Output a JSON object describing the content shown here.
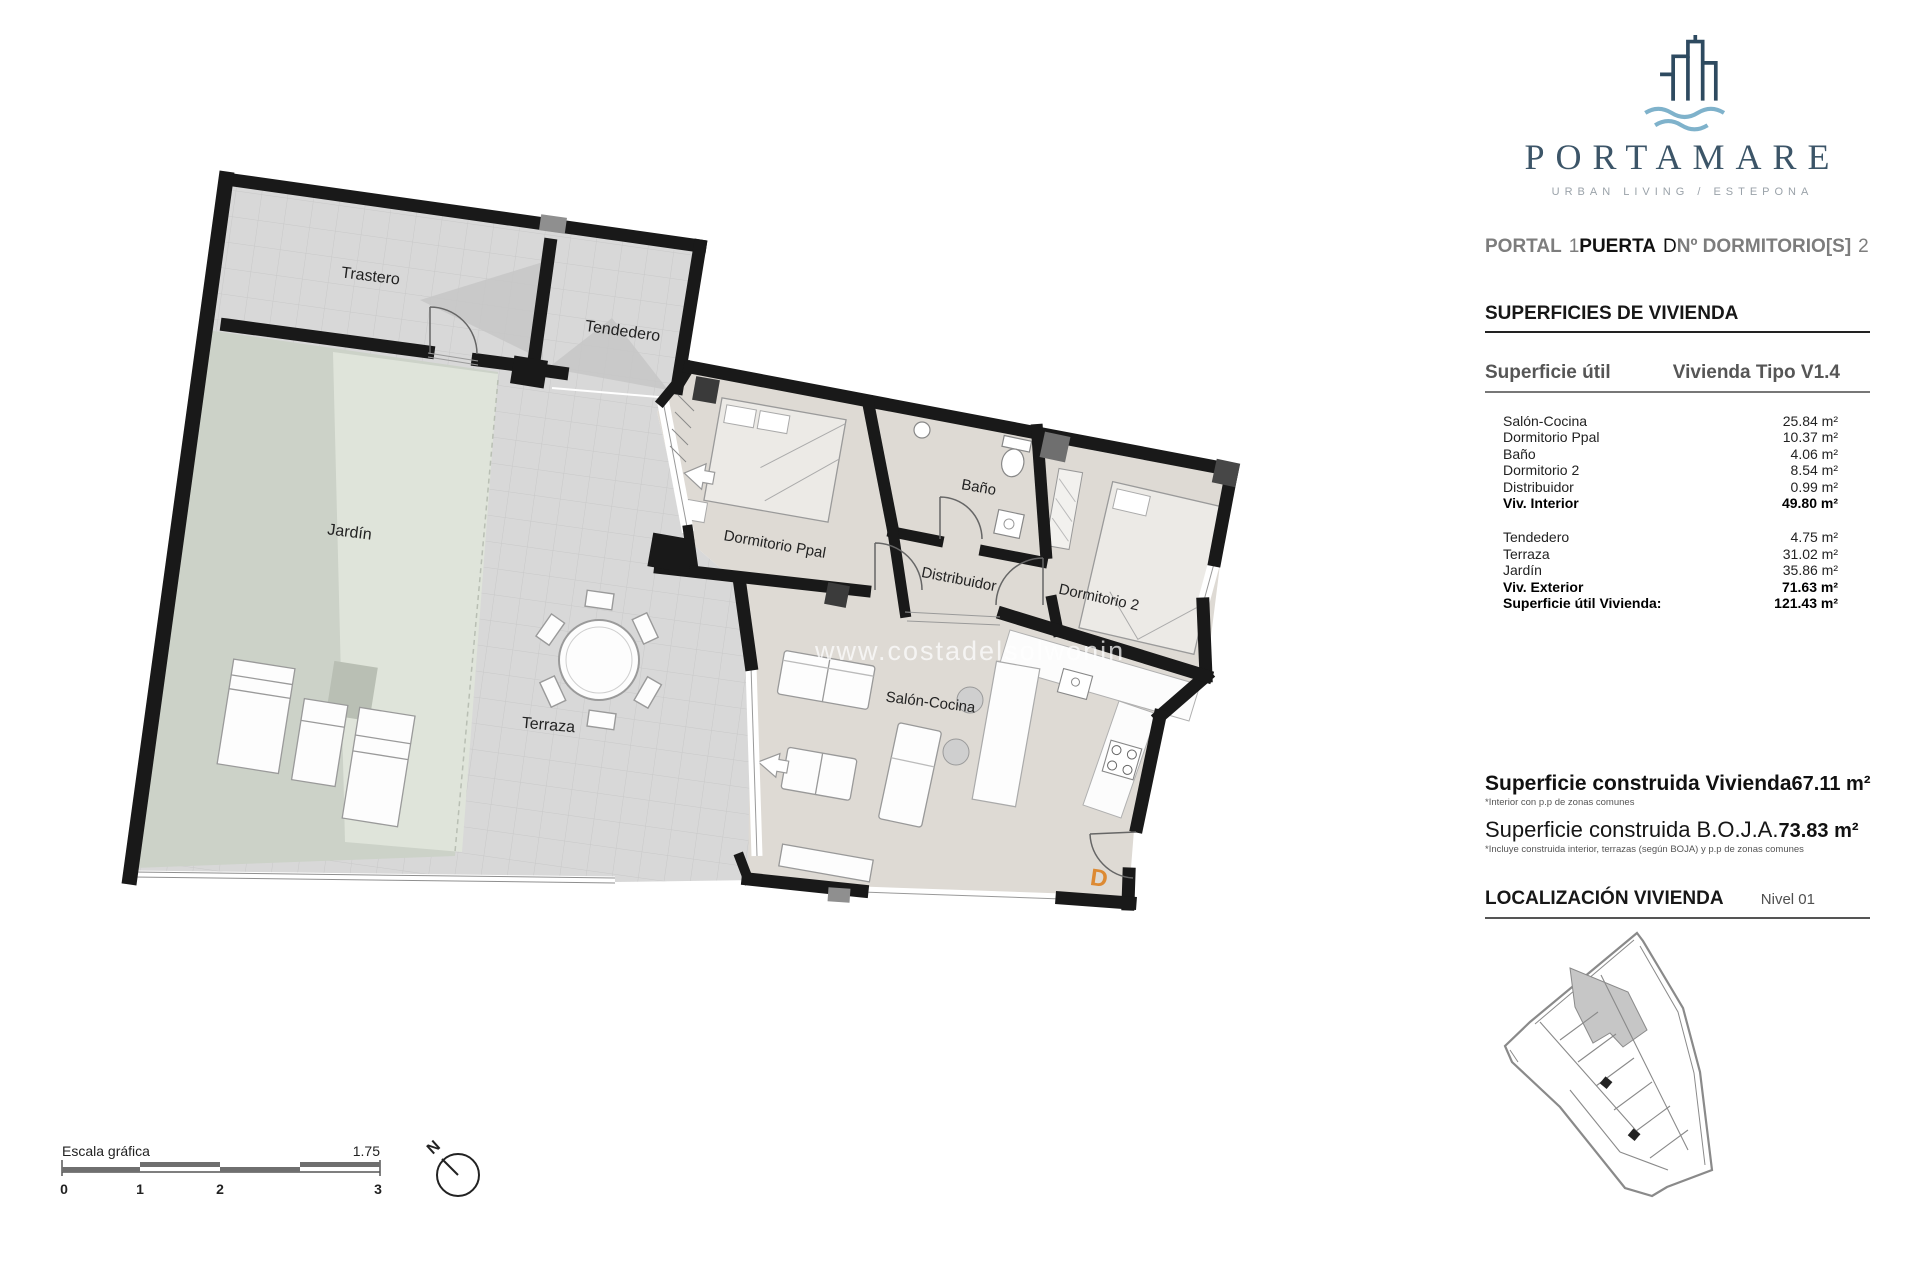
{
  "logo": {
    "brand": "PORTAMARE",
    "tagline": "URBAN LIVING / ESTEPONA"
  },
  "colors": {
    "accent_orange": "#dd8a33",
    "logo_navy": "#33506a",
    "wave_blue": "#7fb2cb"
  },
  "header": {
    "portal_label": "PORTAL",
    "portal_value": "1",
    "puerta_label": "PUERTA",
    "puerta_value": "D",
    "dormitorios_label": "Nº DORMITORIO[S]",
    "dormitorios_value": "2"
  },
  "superficies": {
    "title": "SUPERFICIES DE VIVIENDA",
    "util": {
      "label": "Superficie útil",
      "tipo": "Vivienda Tipo V1.4",
      "rows": [
        {
          "label": "Salón-Cocina",
          "value": "25.84 m²"
        },
        {
          "label": "Dormitorio Ppal",
          "value": "10.37 m²"
        },
        {
          "label": "Baño",
          "value": "4.06 m²"
        },
        {
          "label": "Dormitorio 2",
          "value": "8.54 m²"
        },
        {
          "label": "Distribuidor",
          "value": "0.99 m²"
        },
        {
          "label": "Viv. Interior",
          "value": "49.80 m²"
        },
        {
          "label": "Tendedero",
          "value": "4.75 m²"
        },
        {
          "label": "Terraza",
          "value": "31.02 m²"
        },
        {
          "label": "Jardín",
          "value": "35.86 m²"
        },
        {
          "label": "Viv. Exterior",
          "value": "71.63 m²"
        },
        {
          "label": "Superficie útil Vivienda:",
          "value": "121.43 m²"
        }
      ]
    },
    "construida": {
      "row1_label": "Superficie construida Vivienda",
      "row1_value": "67.11 m²",
      "row1_note": "*Interior con p.p de zonas comunes",
      "row2_label": "Superficie construida B.O.J.A.",
      "row2_value": "73.83 m²",
      "row2_note": "*Incluye construida interior, terrazas (según BOJA) y p.p de zonas comunes"
    }
  },
  "localizacion": {
    "title": "LOCALIZACIÓN VIVIENDA",
    "nivel": "Nivel 01"
  },
  "plan": {
    "rooms": {
      "trastero": "Trastero",
      "tendedero": "Tendedero",
      "jardin": "Jardín",
      "terraza": "Terraza",
      "dormitorio_ppal": "Dormitorio Ppal",
      "bano": "Baño",
      "distribuidor": "Distribuidor",
      "dormitorio2": "Dormitorio 2",
      "salon": "Salón-Cocina"
    },
    "door_letter": "D",
    "watermark": "www.costadelsolwonin"
  },
  "scalebar": {
    "label": "Escala gráfica",
    "ratio": "1.75",
    "ticks": [
      "0",
      "1",
      "2",
      "3"
    ]
  },
  "compass": {
    "north": "N"
  }
}
